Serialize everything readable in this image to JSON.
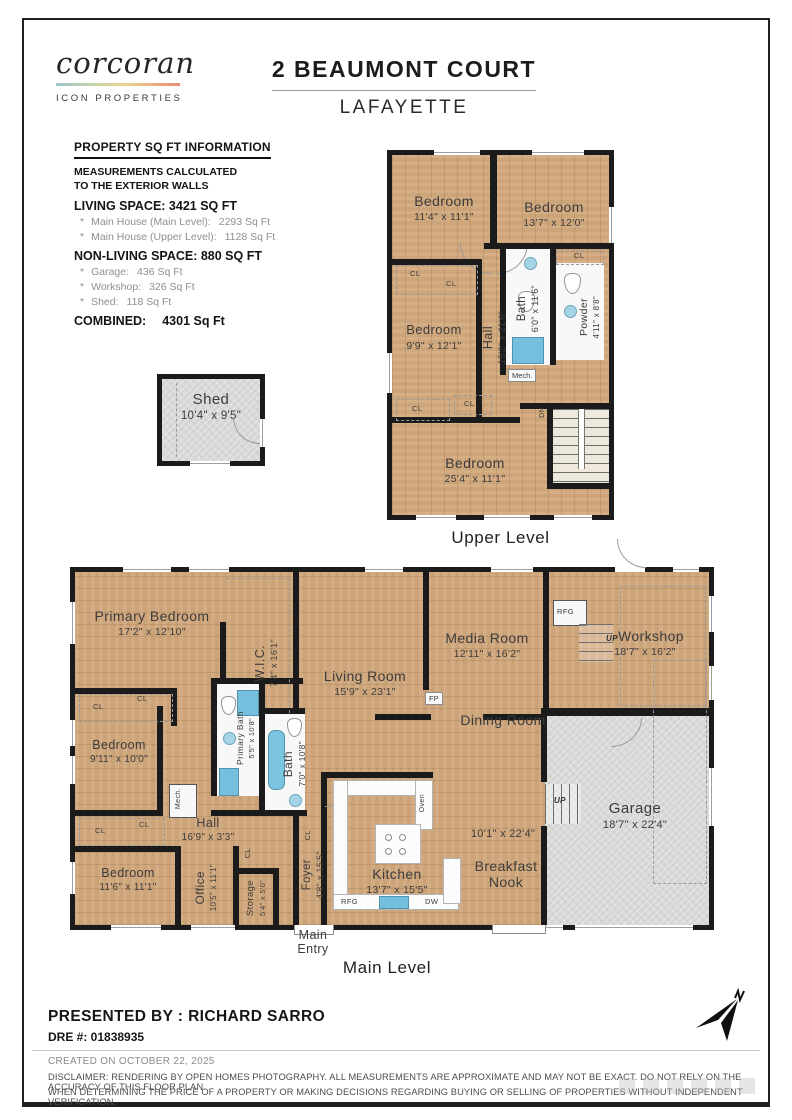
{
  "header": {
    "brand": "corcoran",
    "brand_sub": "ICON PROPERTIES",
    "title": "2 BEAUMONT COURT",
    "subtitle": "LAFAYETTE"
  },
  "sqft": {
    "heading": "PROPERTY SQ FT INFORMATION",
    "note_line1": "MEASUREMENTS CALCULATED",
    "note_line2": "TO THE EXTERIOR WALLS",
    "living_heading": "LIVING SPACE: 3421 SQ FT",
    "living_items": [
      {
        "label": "Main House (Main Level):",
        "value": "2293 Sq Ft"
      },
      {
        "label": "Main House (Upper Level):",
        "value": "1128 Sq Ft"
      }
    ],
    "nonliving_heading": "NON-LIVING SPACE: 880 SQ FT",
    "nonliving_items": [
      {
        "label": "Garage:",
        "value": "436 Sq Ft"
      },
      {
        "label": "Workshop:",
        "value": "326 Sq Ft"
      },
      {
        "label": "Shed:",
        "value": "118 Sq Ft"
      }
    ],
    "combined_label": "COMBINED:",
    "combined_value": "4301  Sq Ft"
  },
  "shed": {
    "name": "Shed",
    "dims": "10'4\" x 9'5\""
  },
  "upper": {
    "caption": "Upper Level",
    "rooms": {
      "bedroom_a": {
        "name": "Bedroom",
        "dims": "11'4\" x 11'1\""
      },
      "bedroom_b": {
        "name": "Bedroom",
        "dims": "13'7\" x 12'0\""
      },
      "bedroom_c": {
        "name": "Bedroom",
        "dims": "9'9\" x 12'1\""
      },
      "hall": {
        "name": "Hall",
        "dims": "15'2\" x 21'6\""
      },
      "bath": {
        "name": "Bath",
        "dims": "6'0\" x 11'6\""
      },
      "powder": {
        "name": "Powder",
        "dims": "4'11\" x 8'8\""
      },
      "bedroom_d": {
        "name": "Bedroom",
        "dims": "25'4\" x 11'1\""
      }
    }
  },
  "main": {
    "caption": "Main Level",
    "entry_line1": "Main",
    "entry_line2": "Entry",
    "rooms": {
      "primary_bedroom": {
        "name": "Primary Bedroom",
        "dims": "17'2\" x 12'10\""
      },
      "wic": {
        "name": "W.I.C.",
        "dims": "7'4\" x 16'1\""
      },
      "living": {
        "name": "Living Room",
        "dims": "15'9\" x 23'1\""
      },
      "media": {
        "name": "Media Room",
        "dims": "12'11\" x 16'2\""
      },
      "workshop": {
        "name": "Workshop",
        "dims": "18'7\" x 16'2\""
      },
      "bedroom_b": {
        "name": "Bedroom",
        "dims": "9'11\" x 10'0\""
      },
      "primary_bath": {
        "name": "Primary Bath",
        "dims": "5'5\" x 10'8\""
      },
      "bath": {
        "name": "Bath",
        "dims": "7'0\" x 10'8\""
      },
      "hall": {
        "name": "Hall",
        "dims": "16'9\" x 3'3\""
      },
      "dining": {
        "name": "Dining Room",
        "dims": "10'1\" x 22'4\""
      },
      "breakfast": {
        "name": "Breakfast Nook"
      },
      "garage": {
        "name": "Garage",
        "dims": "18'7\" x 22'4\""
      },
      "kitchen": {
        "name": "Kitchen",
        "dims": "13'7\" x 15'5\""
      },
      "foyer": {
        "name": "Foyer",
        "dims": "4'8\" x 15'5\""
      },
      "bedroom_c": {
        "name": "Bedroom",
        "dims": "11'6\" x 11'1\""
      },
      "office": {
        "name": "Office",
        "dims": "10'5\" x 11'1\""
      },
      "storage": {
        "name": "Storage",
        "dims": "5'4\" x 5'0\""
      }
    }
  },
  "tags": {
    "cl": "CL",
    "dn": "DN",
    "up": "UP",
    "rfg": "RFG",
    "dw": "DW",
    "oven": "Oven",
    "mech": "Mech.",
    "fp": "FP"
  },
  "footer": {
    "presented_by": "PRESENTED BY : RICHARD SARRO",
    "dre": "DRE #: 01838935",
    "created": "CREATED ON OCTOBER 22, 2025",
    "disclaimer_1": "DISCLAIMER: RENDERING BY OPEN HOMES PHOTOGRAPHY. ALL MEASUREMENTS ARE APPROXIMATE AND MAY NOT BE EXACT. DO NOT RELY ON THE ACCURACY OF THIS FLOOR PLAN",
    "disclaimer_2": "WHEN DETERMINING THE PRICE OF A PROPERTY OR MAKING DECISIONS REGARDING BUYING OR SELLING OF PROPERTIES WITHOUT INDEPENDENT VERIFICATION."
  },
  "colors": {
    "wood": "#d2a87c",
    "concrete": "#d9d9d7",
    "wall": "#1b1b1b",
    "water": "#7cc5e0"
  }
}
